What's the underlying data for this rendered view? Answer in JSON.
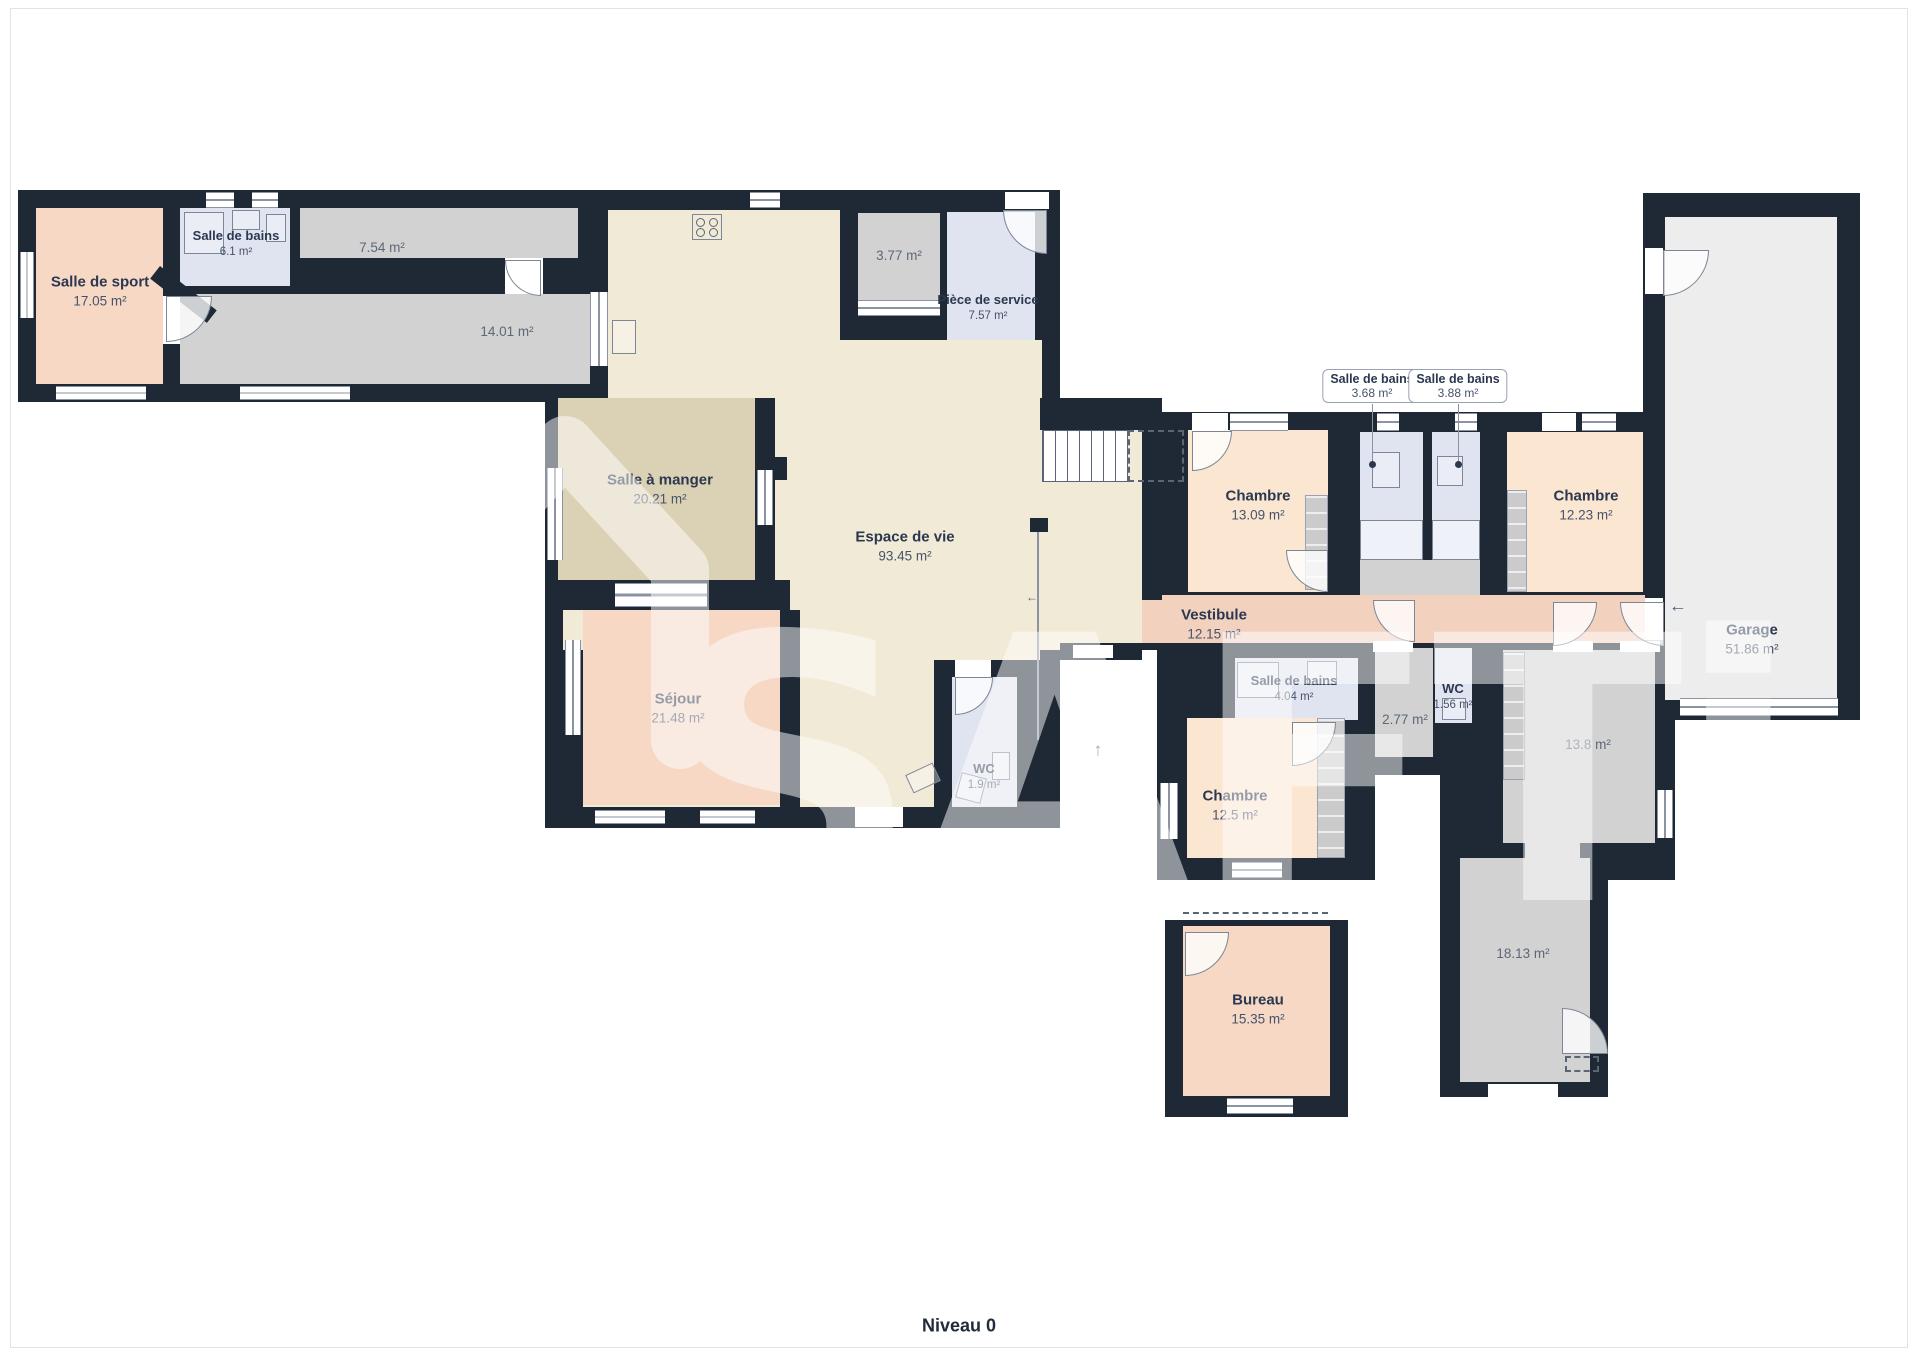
{
  "floor": {
    "label": "Niveau 0"
  },
  "watermark": {
    "brand": "SAFTi"
  },
  "colors": {
    "wall": "#1e2935",
    "living": "#f1ead6",
    "dining": "#dbd1b4",
    "lounge": "#f6d8c5",
    "bedroom": "#fbe6d2",
    "vestibule": "#f2d2bf",
    "bathroom": "#dfe4f0",
    "utility": "#d2d2d2",
    "garage": "#ededed",
    "label_text": "#2b3850"
  },
  "rooms": [
    {
      "id": "salle-de-sport",
      "name": "Salle de sport",
      "area": "17.05 m²",
      "x": 100,
      "y": 291
    },
    {
      "id": "salle-de-bains-6-1",
      "name": "Salle de bains",
      "area": "6.1 m²",
      "x": 236,
      "y": 244,
      "style": "sm"
    },
    {
      "id": "piece-7-54",
      "name": "",
      "area": "7.54 m²",
      "x": 382,
      "y": 248,
      "style": "lt"
    },
    {
      "id": "piece-14-01",
      "name": "",
      "area": "14.01 m²",
      "x": 507,
      "y": 332,
      "style": "lt"
    },
    {
      "id": "salle-a-manger",
      "name": "Salle à manger",
      "area": "20.21 m²",
      "x": 660,
      "y": 489
    },
    {
      "id": "espace-de-vie",
      "name": "Espace de vie",
      "area": "93.45 m²",
      "x": 905,
      "y": 546
    },
    {
      "id": "sejour",
      "name": "Séjour",
      "area": "21.48 m²",
      "x": 678,
      "y": 708
    },
    {
      "id": "piece-3-77",
      "name": "",
      "area": "3.77 m²",
      "x": 899,
      "y": 256,
      "style": "lt"
    },
    {
      "id": "piece-de-service",
      "name": "Pièce de service",
      "area": "7.57 m²",
      "x": 988,
      "y": 308,
      "style": "sm"
    },
    {
      "id": "wc-1-9",
      "name": "WC",
      "area": "1.9 m²",
      "x": 984,
      "y": 777,
      "style": "sm"
    },
    {
      "id": "vestibule",
      "name": "Vestibule",
      "area": "12.15 m²",
      "x": 1214,
      "y": 624
    },
    {
      "id": "chambre-13-09",
      "name": "Chambre",
      "area": "13.09 m²",
      "x": 1258,
      "y": 505
    },
    {
      "id": "chambre-12-23",
      "name": "Chambre",
      "area": "12.23 m²",
      "x": 1586,
      "y": 505
    },
    {
      "id": "salle-de-bains-4-04",
      "name": "Salle de bains",
      "area": "4.04 m²",
      "x": 1294,
      "y": 689,
      "style": "sm"
    },
    {
      "id": "piece-2-77",
      "name": "",
      "area": "2.77 m²",
      "x": 1405,
      "y": 720,
      "style": "lt"
    },
    {
      "id": "wc-1-56",
      "name": "WC",
      "area": "1.56 m²",
      "x": 1453,
      "y": 697,
      "style": "sm"
    },
    {
      "id": "chambre-12-5",
      "name": "Chambre",
      "area": "12.5 m²",
      "x": 1235,
      "y": 805
    },
    {
      "id": "piece-13-8",
      "name": "",
      "area": "13.8 m²",
      "x": 1588,
      "y": 745,
      "style": "lt"
    },
    {
      "id": "piece-18-13",
      "name": "",
      "area": "18.13 m²",
      "x": 1523,
      "y": 954,
      "style": "lt"
    },
    {
      "id": "bureau",
      "name": "Bureau",
      "area": "15.35 m²",
      "x": 1258,
      "y": 1009
    },
    {
      "id": "garage",
      "name": "Garage",
      "area": "51.86 m²",
      "x": 1752,
      "y": 639
    }
  ],
  "callouts": [
    {
      "id": "salle-de-bains-3-68",
      "name": "Salle de bains",
      "area": "3.68 m²",
      "x": 1372,
      "y": 386
    },
    {
      "id": "salle-de-bains-3-88",
      "name": "Salle de bains",
      "area": "3.88 m²",
      "x": 1458,
      "y": 386
    }
  ],
  "arrows": [
    {
      "glyph": "↑",
      "x": 1098,
      "y": 750
    },
    {
      "glyph": "←",
      "x": 1678,
      "y": 606
    },
    {
      "glyph": "←",
      "x": 1032,
      "y": 597,
      "small": true
    }
  ]
}
